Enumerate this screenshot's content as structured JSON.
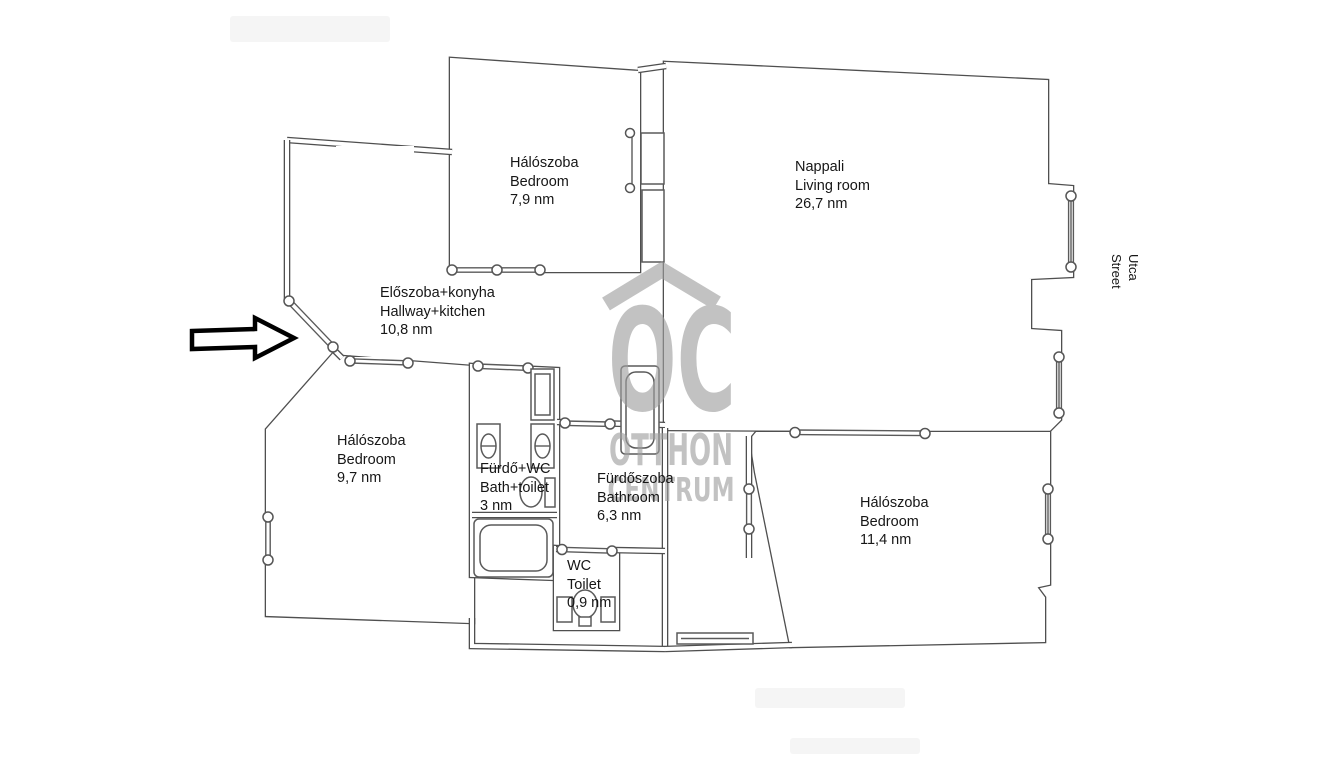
{
  "document": {
    "kind": "apartment floor plan",
    "language": "Hungarian / English",
    "background_color": "#ffffff",
    "wall_color": "#4f4f4f",
    "text_color": "#161616"
  },
  "rooms": [
    {
      "id": "bedroom-top",
      "name_hu": "Hálószoba",
      "name_en": "Bedroom",
      "area": "7,9 nm"
    },
    {
      "id": "living-room",
      "name_hu": "Nappali",
      "name_en": "Living room",
      "area": "26,7 nm"
    },
    {
      "id": "hallway-kitchen",
      "name_hu": "Előszoba+konyha",
      "name_en": "Hallway+kitchen",
      "area": "10,8 nm"
    },
    {
      "id": "bedroom-left",
      "name_hu": "Hálószoba",
      "name_en": "Bedroom",
      "area": "9,7 nm"
    },
    {
      "id": "bath-toilet",
      "name_hu": "Fürdő+WC",
      "name_en": "Bath+toilet",
      "area": "3 nm"
    },
    {
      "id": "bathroom",
      "name_hu": "Fürdőszoba",
      "name_en": "Bathroom",
      "area": "6,3 nm"
    },
    {
      "id": "wc",
      "name_hu": "WC",
      "name_en": "Toilet",
      "area": "0,9 nm"
    },
    {
      "id": "bedroom-right",
      "name_hu": "Hálószoba",
      "name_en": "Bedroom",
      "area": "11,4 nm"
    }
  ],
  "street_label": {
    "hu": "Utca",
    "en": "Street"
  },
  "watermark": {
    "initials": "OC",
    "line1": "OTTHON",
    "line2": "CENTRUM",
    "color": "#a8a8a8"
  }
}
